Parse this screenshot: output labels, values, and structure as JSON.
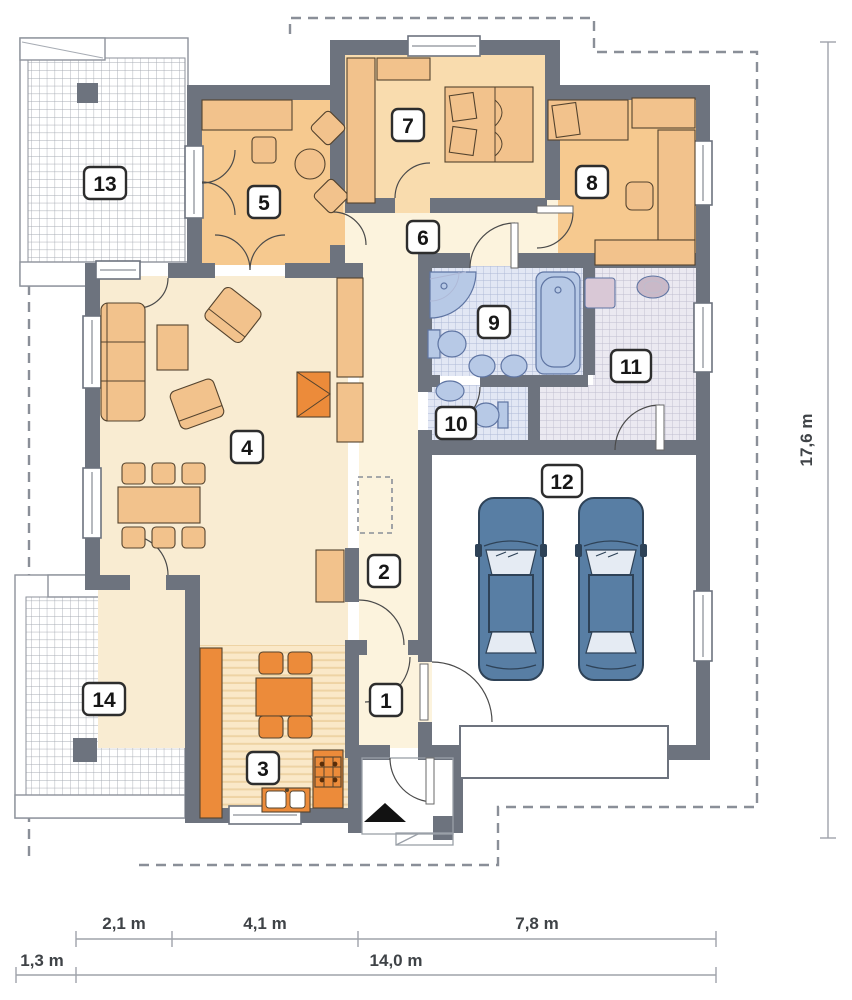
{
  "floor_plan": {
    "room_numbers": [
      "1",
      "2",
      "3",
      "4",
      "5",
      "6",
      "7",
      "8",
      "9",
      "10",
      "11",
      "12",
      "13",
      "14"
    ],
    "dimensions": {
      "right_height": "17,6 m",
      "bottom_segments": [
        "2,1 m",
        "4,1 m",
        "7,8 m"
      ],
      "bottom_offset": "1,3 m",
      "bottom_total": "14,0 m"
    },
    "colors": {
      "wall": "#6d737e",
      "room_peach": "#f6c98f",
      "room_tan": "#f9dcae",
      "cream": "#f9ecd2",
      "cream_light": "#fcf3dd",
      "furniture": "#f2c28c",
      "outline": "#54432e",
      "orange": "#ec8b3a",
      "tile_blue_bg": "#e2e7f4",
      "tile_blue_line": "#aeb8d6",
      "fixture": "#b7c9e6",
      "fixture_stroke": "#5e74a2",
      "tile_gray_bg": "#ebe9f1",
      "tile_gray_line": "#bfbdce",
      "car_body": "#587ea4",
      "car_dark": "#2e4257",
      "car_glass": "#e5ebf3",
      "terrace_grid": "#a6abb3",
      "dash": "#8a8f98",
      "dim_line": "#9fa3aa",
      "dim_text": "#3f4347",
      "machine": "#d9c8d6",
      "sink_gray": "#c9b9c8",
      "stripe_bg": "#fae8c8",
      "stripe_line": "#eed3a4"
    }
  }
}
